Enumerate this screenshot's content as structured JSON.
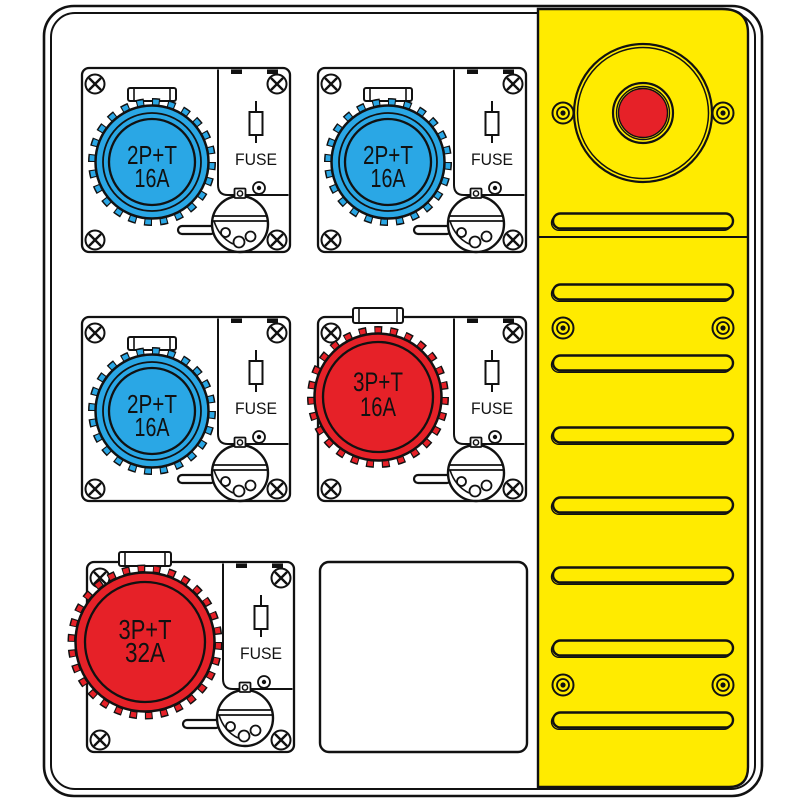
{
  "drawing_title": "Power distribution board with industrial sockets",
  "palette": {
    "panel_yellow": "#FFEB00",
    "socket_blue": "#2AA7E5",
    "socket_red": "#E62128",
    "outline_black": "#111111",
    "plate_white": "#FFFFFF"
  },
  "icons": {
    "plate_screw": "phillips-screw-icon",
    "panel_screw": "concentric-ring-screw-icon",
    "fuse": "fuse-cartridge-icon",
    "vent": "vent-slot"
  },
  "board": {
    "modules": [
      {
        "name": "socket-module-top-left",
        "position": "top-left",
        "socket_type": "2P+T 16A",
        "color": "socket_blue",
        "size": "small",
        "label_line1": "2P+T",
        "label_line2": "16A",
        "fuse_label": "FUSE"
      },
      {
        "name": "socket-module-top-center",
        "position": "top-center",
        "socket_type": "2P+T 16A",
        "color": "socket_blue",
        "size": "small",
        "label_line1": "2P+T",
        "label_line2": "16A",
        "fuse_label": "FUSE"
      },
      {
        "name": "socket-module-middle-left",
        "position": "middle-left",
        "socket_type": "2P+T 16A",
        "color": "socket_blue",
        "size": "small",
        "label_line1": "2P+T",
        "label_line2": "16A",
        "fuse_label": "FUSE"
      },
      {
        "name": "socket-module-middle-center",
        "position": "middle-center",
        "socket_type": "3P+T 16A",
        "color": "socket_red",
        "size": "medium",
        "label_line1": "3P+T",
        "label_line2": "16A",
        "fuse_label": "FUSE"
      },
      {
        "name": "socket-module-bottom-left",
        "position": "bottom-left",
        "socket_type": "3P+T 32A",
        "color": "socket_red",
        "size": "large",
        "label_line1": "3P+T",
        "label_line2": "32A",
        "fuse_label": "FUSE"
      }
    ],
    "blank_plate": {
      "name": "blank-cover-plate",
      "position": "bottom-center"
    },
    "side_panel": {
      "name": "yellow-side-panel",
      "color": "panel_yellow",
      "emergency_stop": {
        "name": "emergency-stop-button",
        "button_color": "socket_red"
      },
      "vent_slot_count": 8,
      "screw_pair_count": 3
    }
  }
}
